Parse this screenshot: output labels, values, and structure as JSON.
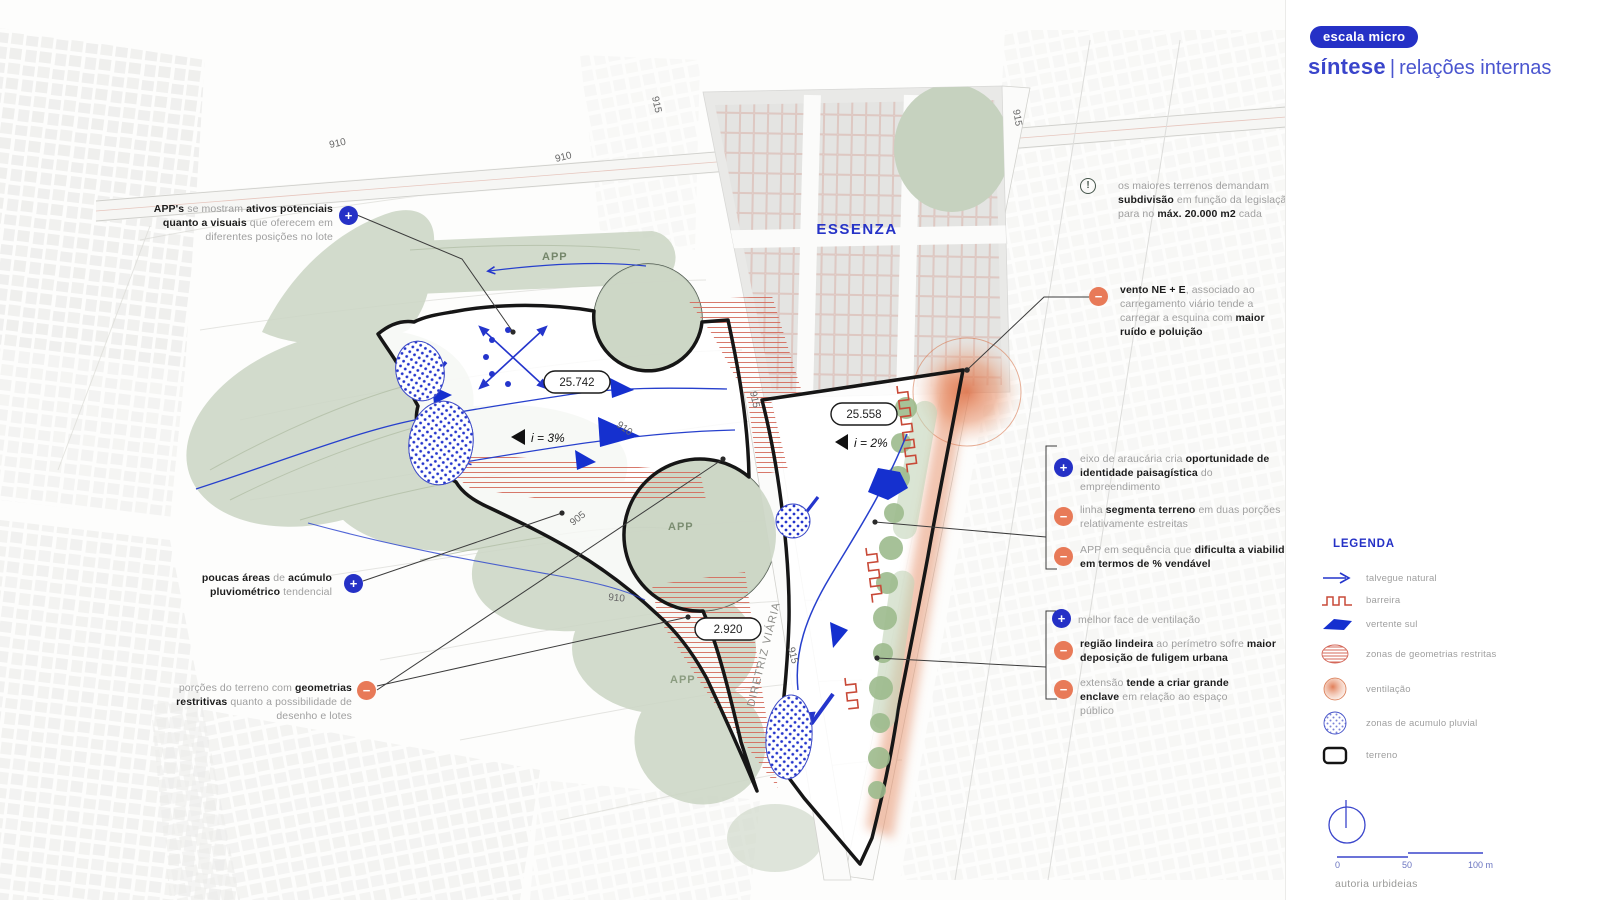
{
  "panel": {
    "tag": "escala micro",
    "title_main": "síntese",
    "title_sep": "|",
    "title_sub": "relações internas",
    "credit": "autoria urbideias"
  },
  "signs": {
    "plus": "+",
    "minus": "−",
    "alert": "!"
  },
  "colors": {
    "accent_blue": "#2531c6",
    "negative_orange": "#e87a58",
    "alert_green": "#46564c",
    "app_green": "#ccd6c5",
    "hatch_red": "#d4685a"
  },
  "legend": {
    "heading": "LEGENDA",
    "items": [
      {
        "id": "talvegue",
        "label": "talvegue natural"
      },
      {
        "id": "barreira",
        "label": "barreira"
      },
      {
        "id": "vertente",
        "label": "vertente sul"
      },
      {
        "id": "geometrias",
        "label": "zonas de geometrias restritas"
      },
      {
        "id": "ventilacao",
        "label": "ventilação"
      },
      {
        "id": "pluvial",
        "label": "zonas de acumulo pluvial"
      },
      {
        "id": "terreno",
        "label": "terreno"
      }
    ]
  },
  "scalebar": {
    "t0": "0",
    "t50": "50",
    "t100": "100 m"
  },
  "map": {
    "labels": {
      "essenza": "ESSENZA",
      "app": "APP",
      "diretriz": "DIRETRIZ VIÁRIA",
      "area_left": "25.742",
      "area_right": "25.558",
      "area_tail": "2.920",
      "slope_left": "i = 3%",
      "slope_right": "i = 2%",
      "c910": "910",
      "c915": "915",
      "c905": "905"
    }
  },
  "annotations": {
    "app_visuais": {
      "type": "positive",
      "segments": [
        {
          "t": "APP's",
          "b": 1
        },
        {
          "t": " se mostram ",
          "b": 0
        },
        {
          "t": "ativos potenciais quanto a visuais",
          "b": 1
        },
        {
          "t": " que oferecem em diferentes posições no lote",
          "b": 0
        }
      ]
    },
    "acumulo": {
      "type": "positive",
      "segments": [
        {
          "t": "poucas áreas",
          "b": 1
        },
        {
          "t": " de ",
          "b": 0
        },
        {
          "t": "acúmulo pluviométrico",
          "b": 1
        },
        {
          "t": " tendencial",
          "b": 0
        }
      ]
    },
    "geometrias": {
      "type": "negative",
      "segments": [
        {
          "t": "porções do terreno com ",
          "b": 0
        },
        {
          "t": "geometrias restritivas",
          "b": 1
        },
        {
          "t": " quanto a possibilidade de desenho e lotes",
          "b": 0
        }
      ]
    },
    "subdivisao": {
      "type": "alert",
      "segments": [
        {
          "t": "os maiores terrenos demandam ",
          "b": 0
        },
        {
          "t": "subdivisão",
          "b": 1
        },
        {
          "t": " em função da legislação para no ",
          "b": 0
        },
        {
          "t": "máx. 20.000 m2",
          "b": 1
        },
        {
          "t": " cada",
          "b": 0
        }
      ]
    },
    "vento": {
      "type": "negative",
      "segments": [
        {
          "t": "vento NE + E",
          "b": 1
        },
        {
          "t": ", associado ao carregamento viário tende a carregar a esquina com ",
          "b": 0
        },
        {
          "t": "maior ruído e poluição",
          "b": 1
        }
      ]
    },
    "eixo": {
      "type": "positive",
      "segments": [
        {
          "t": "eixo de araucária cria ",
          "b": 0
        },
        {
          "t": "oportunidade de identidade paisagística",
          "b": 1
        },
        {
          "t": " do empreendimento",
          "b": 0
        }
      ]
    },
    "linha": {
      "type": "negative",
      "segments": [
        {
          "t": "linha ",
          "b": 0
        },
        {
          "t": "segmenta terreno",
          "b": 1
        },
        {
          "t": " em duas porções relativamente estreitas",
          "b": 0
        }
      ]
    },
    "app_sequencia": {
      "type": "negative",
      "segments": [
        {
          "t": "APP em sequência que ",
          "b": 0
        },
        {
          "t": "dificulta a viabilidade em termos de % vendável",
          "b": 1
        }
      ]
    },
    "ventilacao_face": {
      "type": "positive",
      "segments": [
        {
          "t": "melhor face de ventilação",
          "b": 0
        }
      ]
    },
    "lindeira": {
      "type": "negative",
      "segments": [
        {
          "t": "região lindeira",
          "b": 1
        },
        {
          "t": " ao perímetro sofre ",
          "b": 0
        },
        {
          "t": "maior deposição de fuligem urbana",
          "b": 1
        }
      ]
    },
    "enclave": {
      "type": "negative",
      "segments": [
        {
          "t": "extensão ",
          "b": 0
        },
        {
          "t": "tende a criar grande enclave",
          "b": 1
        },
        {
          "t": " em relação ao espaço público",
          "b": 0
        }
      ]
    }
  }
}
